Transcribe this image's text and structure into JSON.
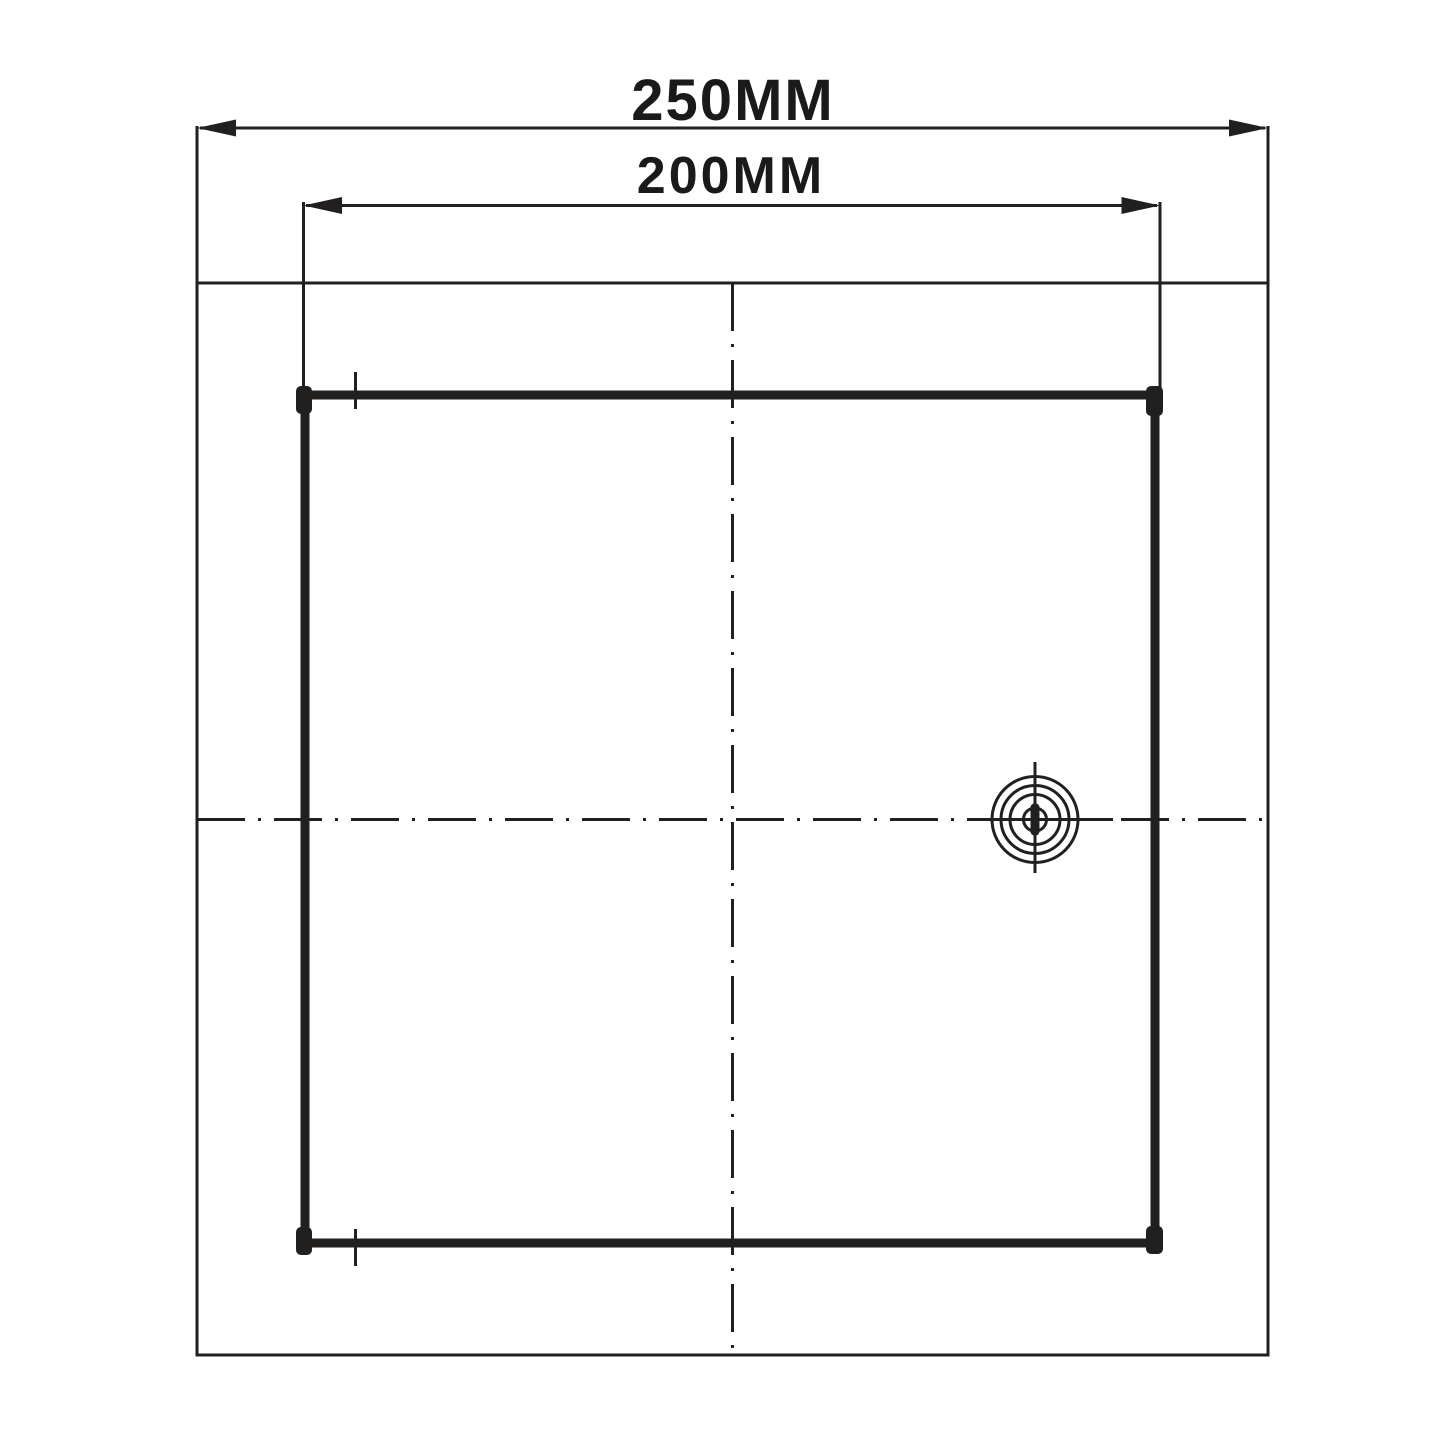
{
  "drawing": {
    "background": "#ffffff",
    "line_color": "#221f1f"
  },
  "dimensions": {
    "outer": {
      "label": "250MM",
      "value": 250,
      "unit": "MM"
    },
    "inner": {
      "label": "200MM",
      "value": 200,
      "unit": "MM"
    }
  },
  "icons": {
    "lock": "lock-keyhole-icon"
  }
}
